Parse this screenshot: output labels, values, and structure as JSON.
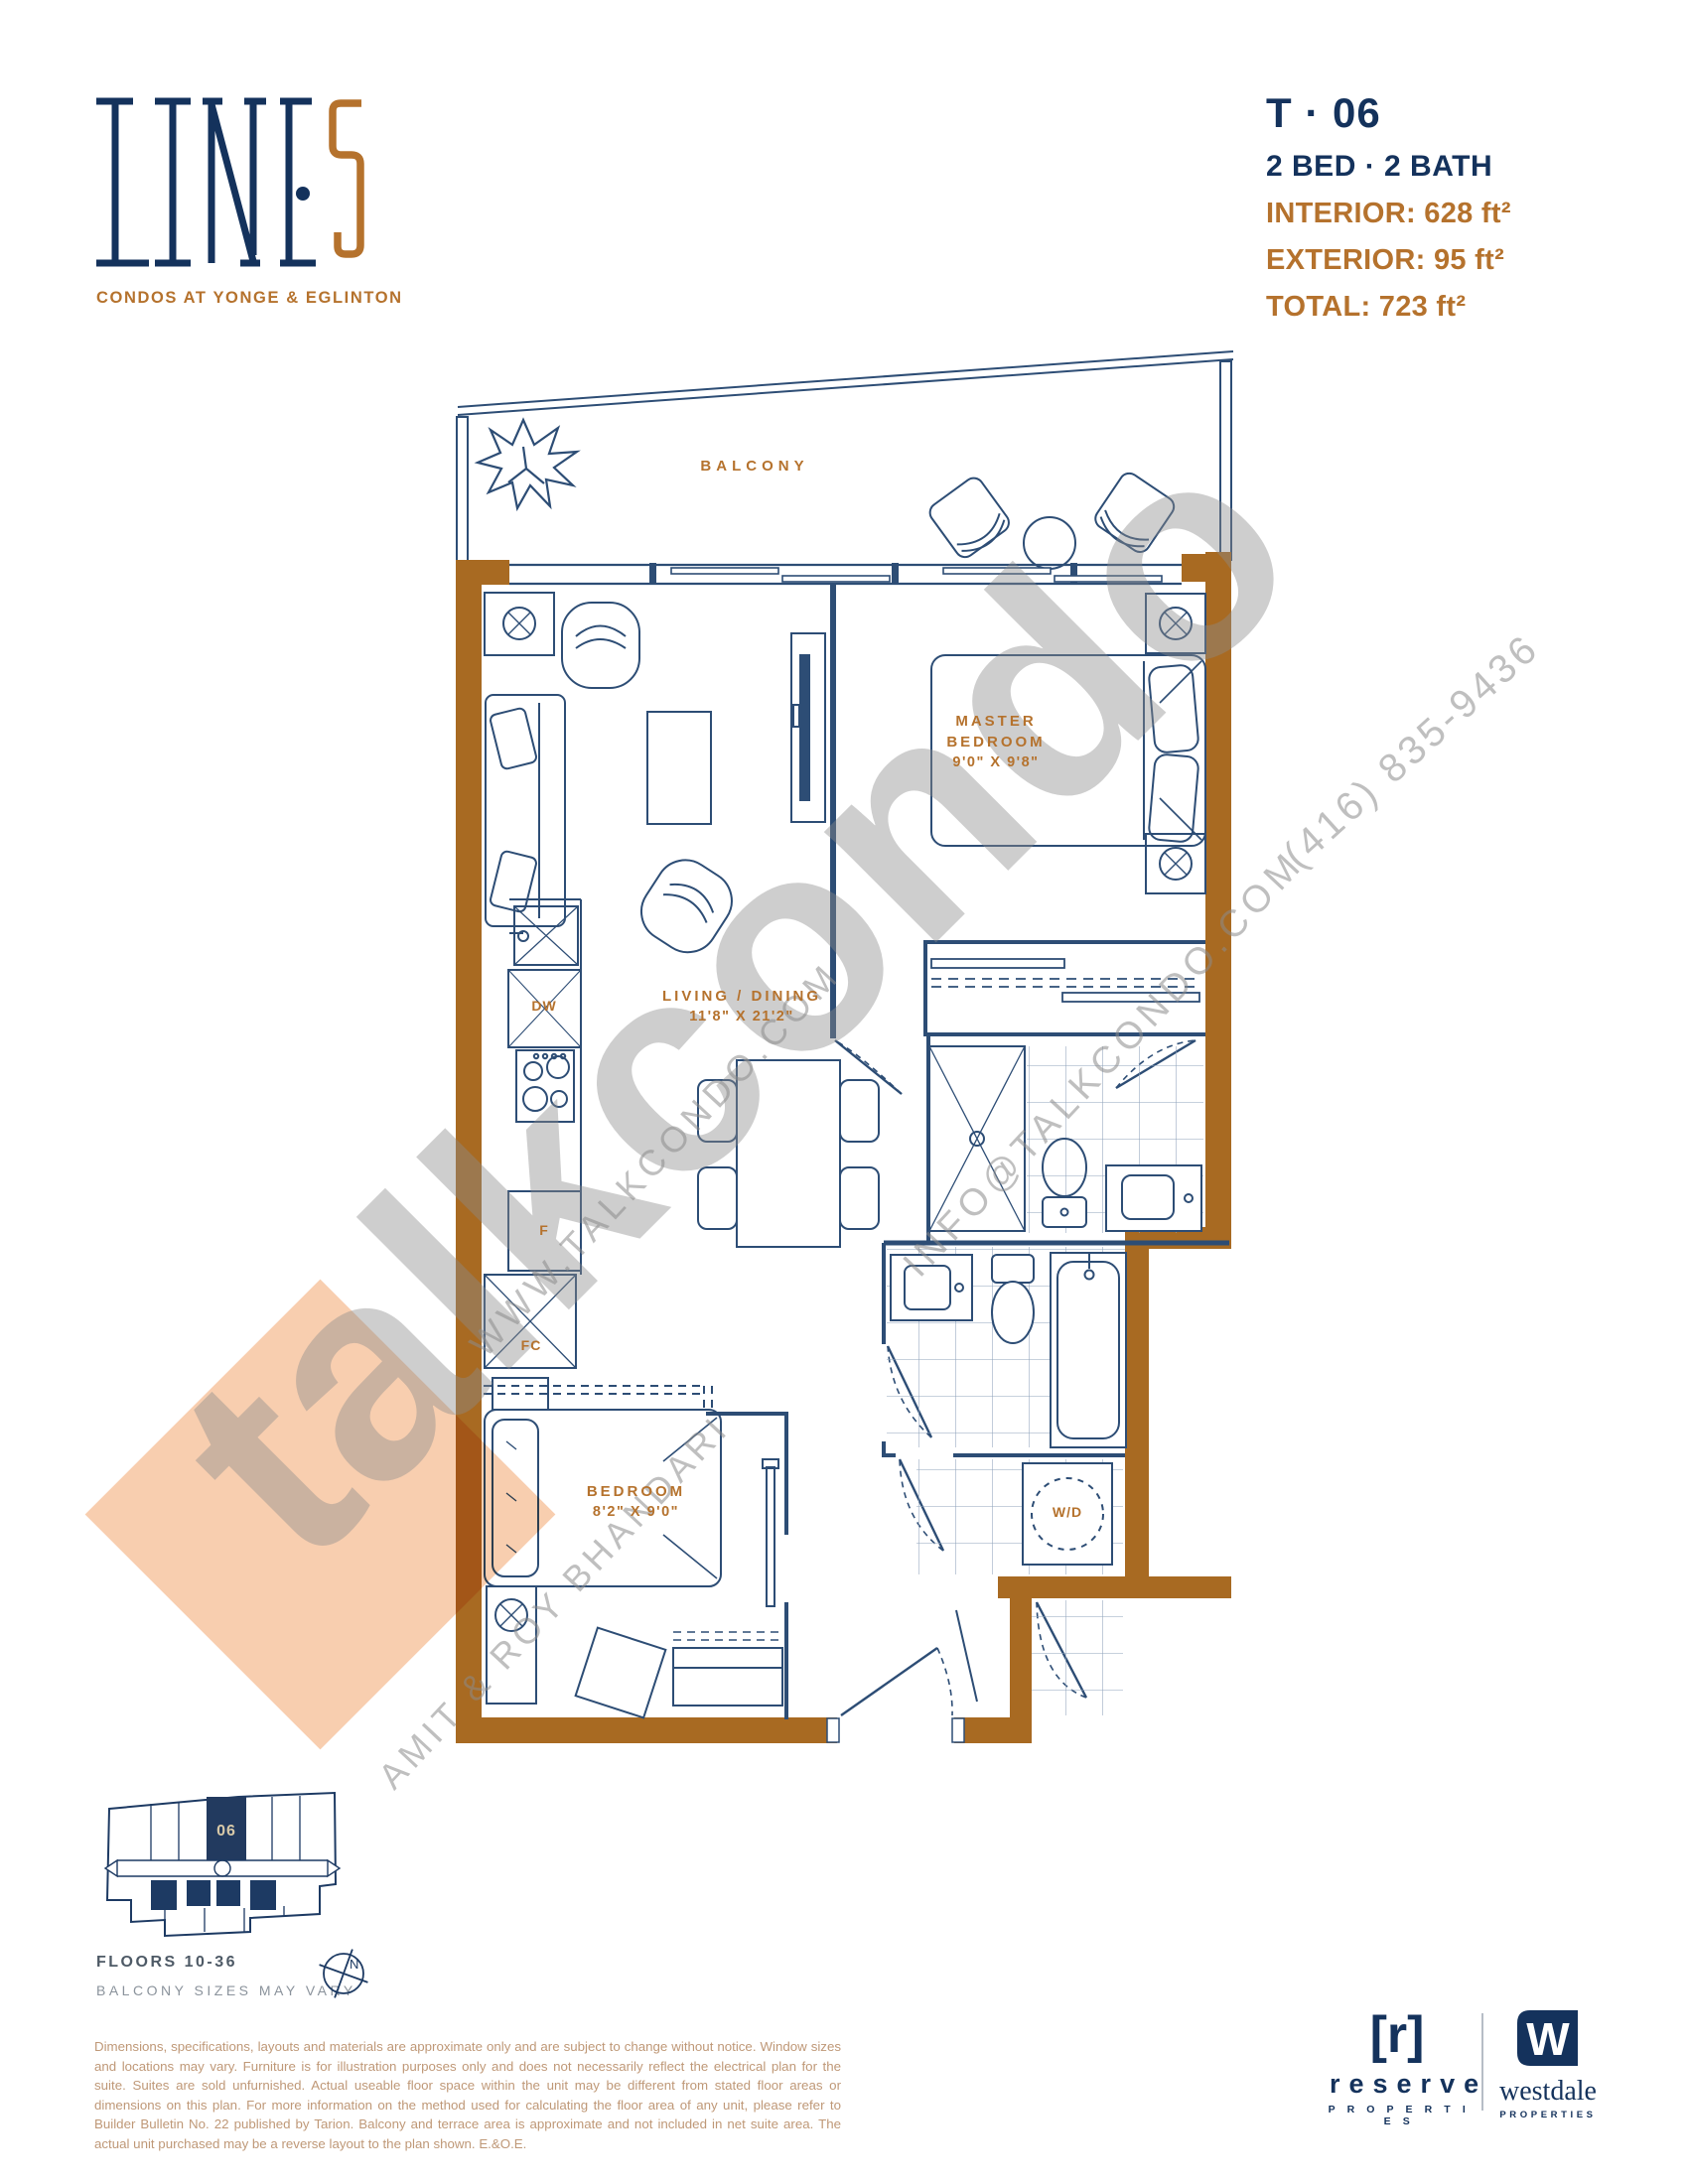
{
  "brand": {
    "name": "LINE 5",
    "subtitle": "CONDOS AT YONGE & EGLINTON"
  },
  "unit": {
    "number": "T · 06",
    "config": "2 BED · 2 BATH",
    "stats": [
      "INTERIOR: 628 ft²",
      "EXTERIOR: 95 ft²",
      "TOTAL: 723 ft²"
    ]
  },
  "floorplan": {
    "balcony": "BALCONY",
    "master": {
      "l1": "MASTER",
      "l2": "BEDROOM",
      "dims": "9'0\" X 9'8\""
    },
    "living": {
      "name": "LIVING / DINING",
      "dims": "11'8\" X 21'2\""
    },
    "bedroom": {
      "name": "BEDROOM",
      "dims": "8'2\" X 9'0\""
    },
    "kitchen": {
      "dw": "DW",
      "f": "F",
      "fc": "FC"
    },
    "wd": "W/D"
  },
  "watermarks": {
    "big": "talkcondo",
    "url": "WWW.TALKCONDO.COM",
    "email": "INFO@TALKCONDO.COM",
    "phone": "(416) 835-9436",
    "agents": "AMIT & ROY BHANDARI"
  },
  "keyplan": {
    "unit_number": "06",
    "floors": "FLOORS 10-36",
    "note": "BALCONY SIZES MAY VARY",
    "north": "N"
  },
  "disclaimer": "Dimensions, specifications, layouts and materials are approximate only and are subject to change without notice. Window sizes and locations may vary. Furniture is for illustration purposes only and does not necessarily reflect the electrical plan for the suite. Suites are sold unfurnished. Actual useable floor space within the unit may be different from stated floor areas or dimensions on this plan. For more information on the method used for calculating the floor area of any unit, please refer to Builder Bulletin No. 22 published by Tarion. Balcony and terrace area is approximate and not included in net suite area. The actual unit purchased may be a reverse layout to the plan shown. E.&O.E.",
  "footer": {
    "reserve": {
      "mark": "[r]",
      "name": "reserve",
      "tag": "P R O P E R T I E S"
    },
    "westdale": {
      "initial": "W",
      "name": "westdale",
      "tag": "PROPERTIES"
    }
  },
  "colors": {
    "navy": "#14325c",
    "plan_line": "#2d4d75",
    "wall_brown": "#a86a22",
    "accent_orange": "#b5722d",
    "watermark_gray": "#8c8c8c",
    "diamond_peach": "#f7c29b",
    "disclaimer_tan": "#bf9877"
  }
}
